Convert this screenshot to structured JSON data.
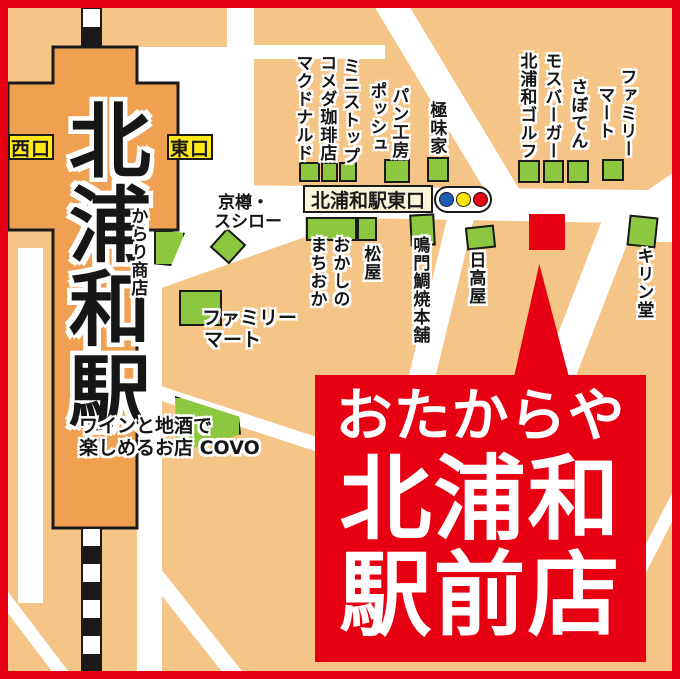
{
  "station": {
    "name": "北浦和駅",
    "west_exit": "西口",
    "east_exit": "東口"
  },
  "signs": {
    "east_exit_road": "北浦和駅東口"
  },
  "shops": {
    "mcdonalds": "マクドナルド",
    "komeda_coffee": "コメダ珈琲店",
    "ministop": "ミニストップ",
    "pain_kobo_posh_line1": "パン工房",
    "pain_kobo_posh_line2": "ポッシュ",
    "gokumiya": "極味家",
    "kitaurawa_golf": "北浦和ゴルフ",
    "mos_burger": "モスバーガー",
    "saboten": "さぼてん",
    "familymart_north_line1": "ファミリー",
    "familymart_north_line2": "マート",
    "kyotaru_line1": "京樽・",
    "kyotaru_line2": "スシロー",
    "karari_shoten": "からり商店",
    "okashi_no_machioka_line1": "おかしの",
    "okashi_no_machioka_line2": "まちおか",
    "matsuya": "松屋",
    "naruto_taiyaki_honpo": "鳴門鯛焼本舗",
    "hidakaya": "日高屋",
    "kirindo": "キリン堂",
    "familymart_south_line1": "ファミリー",
    "familymart_south_line2": "マート",
    "covo_line1": "ワインと地酒で",
    "covo_line2": "楽しめるお店 COVO"
  },
  "banner": {
    "line1": "おたからや",
    "line2": "北浦和",
    "line3": "駅前店"
  },
  "colors": {
    "background_orange": "#F5C588",
    "station_orange": "#F0A051",
    "road_white": "#FFFFFF",
    "building_green": "#8DC63F",
    "accent_red": "#E60012",
    "exit_yellow": "#FFE817",
    "sign_cream": "#FAF4D9",
    "traffic_blue": "#1C5DB5",
    "traffic_yellow": "#FFE800",
    "traffic_red": "#E60012"
  }
}
